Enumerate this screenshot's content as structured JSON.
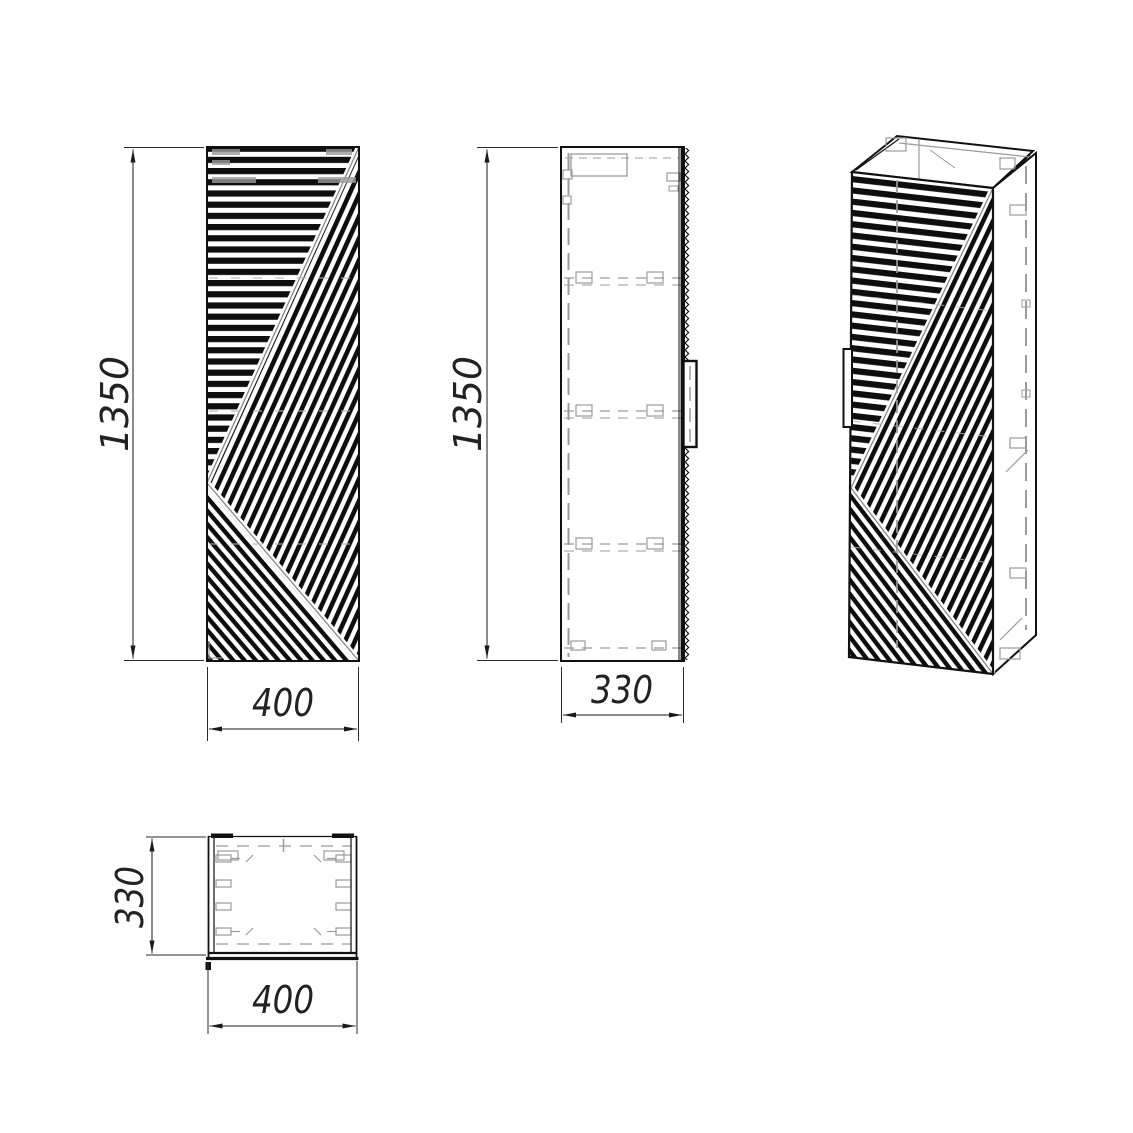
{
  "drawing": {
    "background": "#ffffff",
    "line_color": "#111111",
    "hidden_line_color": "#9b9b9b",
    "dimension_text_color": "#222222",
    "views": {
      "front": {
        "height_label": "1350",
        "width_label": "400"
      },
      "side": {
        "height_label": "1350",
        "depth_label": "330"
      },
      "top": {
        "depth_label": "330",
        "width_label": "400"
      }
    }
  }
}
